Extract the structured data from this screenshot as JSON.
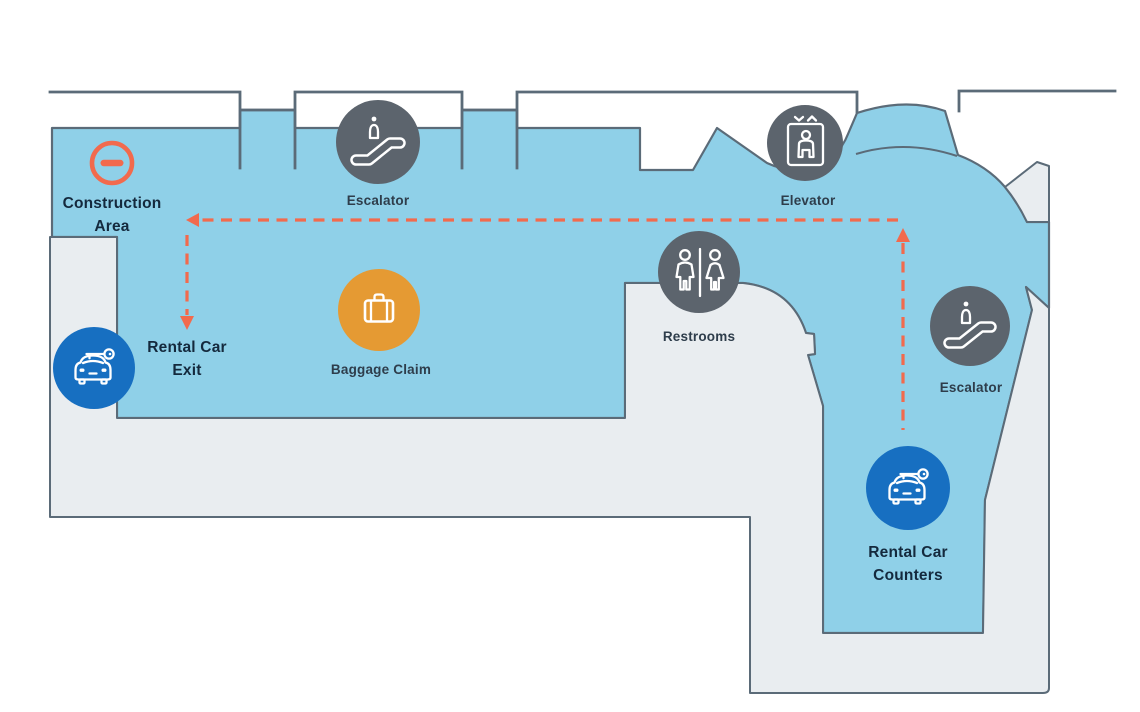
{
  "colors": {
    "floor_blue": "#8FD0E8",
    "floor_gray": "#E9EDF0",
    "outline": "#5B6B78",
    "poi_gray": "#5C646D",
    "poi_blue": "#176FC1",
    "poi_amber": "#E59A33",
    "accent": "#F26A4D",
    "label_dark": "#14293D",
    "label_medium": "#2E3D4B"
  },
  "labels": {
    "construction": {
      "line1": "Construction",
      "line2": "Area"
    },
    "escalator_top": {
      "label": "Escalator"
    },
    "elevator": {
      "label": "Elevator"
    },
    "restrooms": {
      "label": "Restrooms"
    },
    "baggage_claim": {
      "label": "Baggage Claim"
    },
    "escalator_right": {
      "label": "Escalator"
    },
    "rental_exit": {
      "line1": "Rental Car",
      "line2": "Exit"
    },
    "rental_counters": {
      "line1": "Rental Car",
      "line2": "Counters"
    }
  }
}
